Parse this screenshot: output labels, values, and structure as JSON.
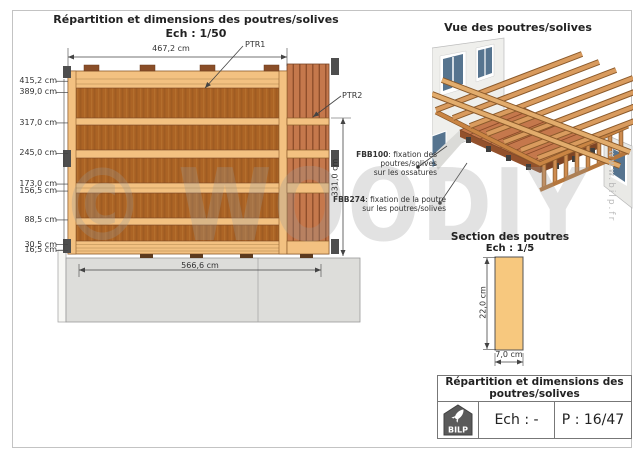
{
  "elevation": {
    "title": "Répartition et dimensions des poutres/solives",
    "scale_label": "Ech : 1/50",
    "top_width": "467,2 cm",
    "bottom_width": "566,6 cm",
    "right_height": "331,0 cm",
    "left_dims": [
      "415,2 cm",
      "389,0 cm",
      "317,0 cm",
      "245,0 cm",
      "173,0 cm",
      "156,5 cm",
      "88,5 cm",
      "30,5 cm",
      "16,5 cm"
    ],
    "ptr1": "PTR1",
    "ptr2": "PTR2"
  },
  "view3d": {
    "title": "Vue des poutres/solives"
  },
  "callouts": {
    "fbb100": {
      "name": "FBB100",
      "line1": ": fixation des",
      "line2": "poutres/solives",
      "line3": "sur les ossatures"
    },
    "fbb274": {
      "name": "FBB274",
      "line1": ": fixation de la poutre",
      "line2": "sur les poutres/solives"
    }
  },
  "section": {
    "title": "Section des poutres",
    "scale_label": "Ech : 1/5",
    "height_dim": "22,0 cm",
    "width_dim": "7,0 cm"
  },
  "title_block": {
    "line1": "Répartition et dimensions des",
    "line2": "poutres/solives",
    "logo_text": "BILP",
    "scale_value": "Ech : -",
    "page_value": "P : 16/47"
  },
  "watermark": "© WOODIY",
  "site_url": "www.bilp.fr",
  "colors": {
    "wood_light": "#F3C181",
    "wood_panel": "#AC6425",
    "wood_planks": "#C5784C",
    "section_fill": "#F7C87E",
    "bracket_gray": "#4E4E4E",
    "base_gray": "#DDDDDA",
    "window_blue": "#56748F"
  }
}
